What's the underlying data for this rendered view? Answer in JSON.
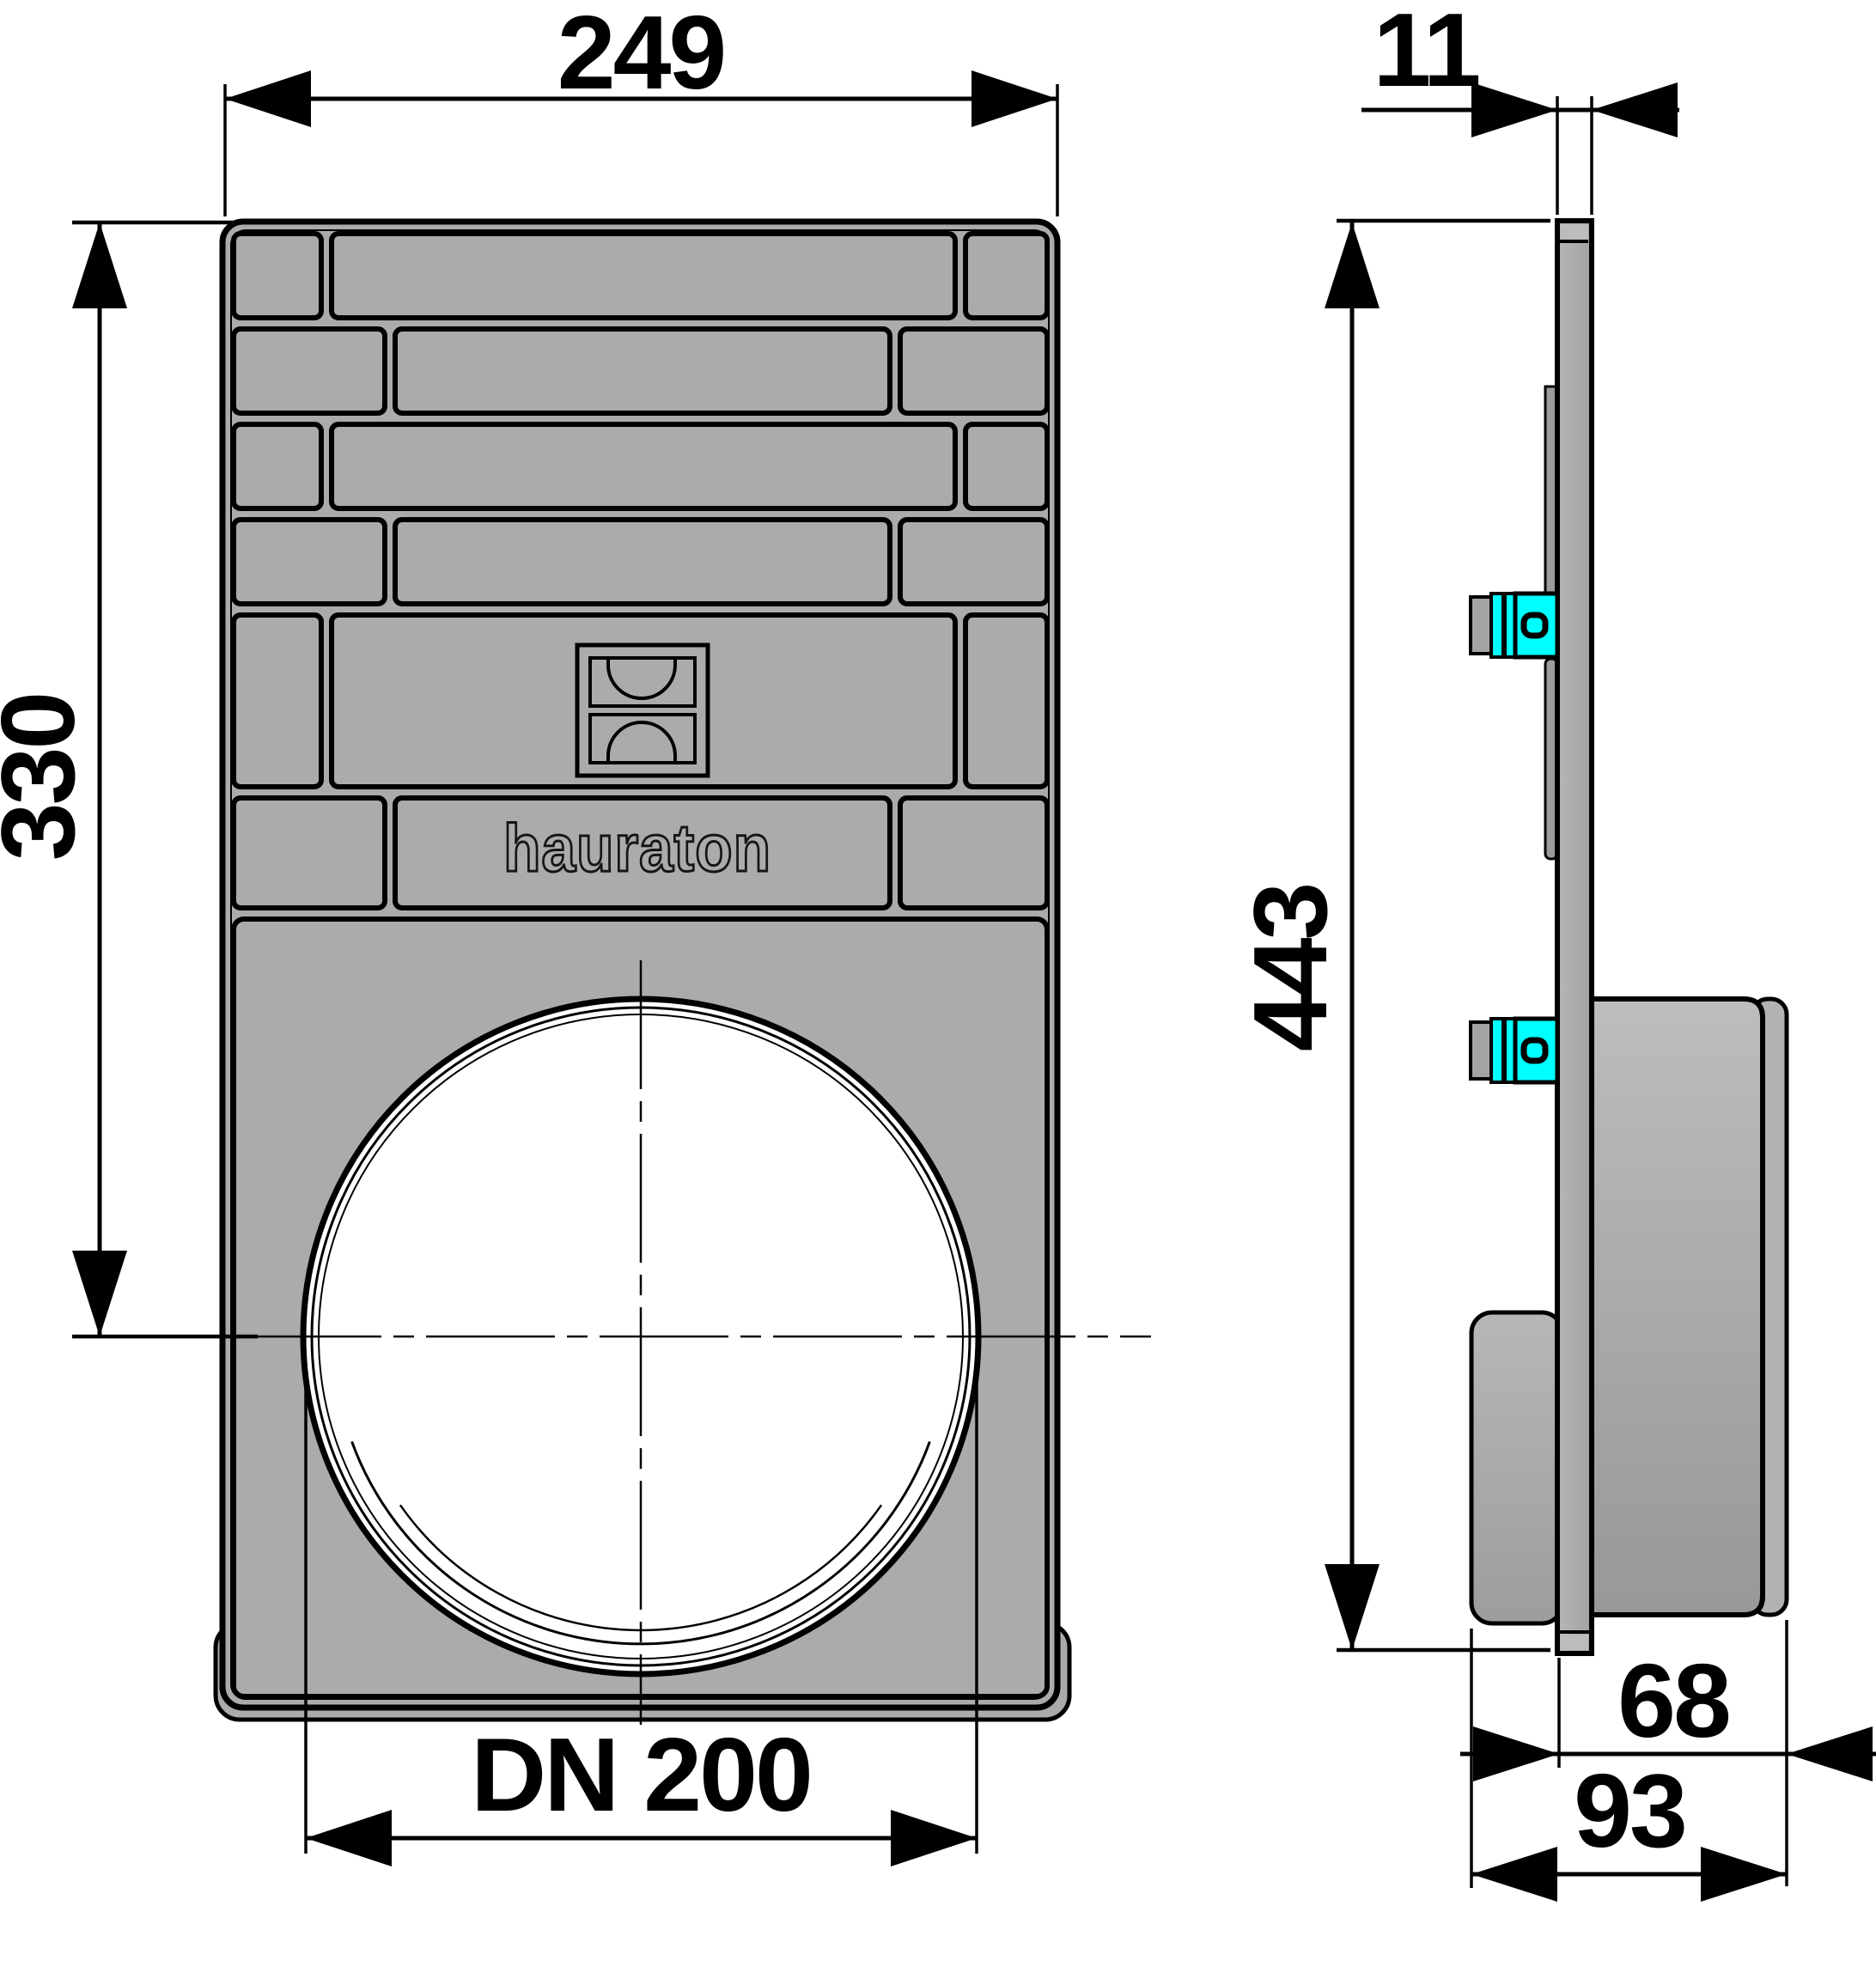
{
  "drawing": {
    "brand_logo_text": "hauraton",
    "dimensions": {
      "front_width": "249",
      "front_height_to_center": "330",
      "outlet_diameter": "DN 200",
      "plate_thickness": "11",
      "total_height": "443",
      "socket_depth": "68",
      "total_depth": "93"
    },
    "colors": {
      "body_gray": "#ababab",
      "accent_cyan": "#00ffff",
      "line_black": "#000000",
      "background": "#ffffff"
    }
  }
}
